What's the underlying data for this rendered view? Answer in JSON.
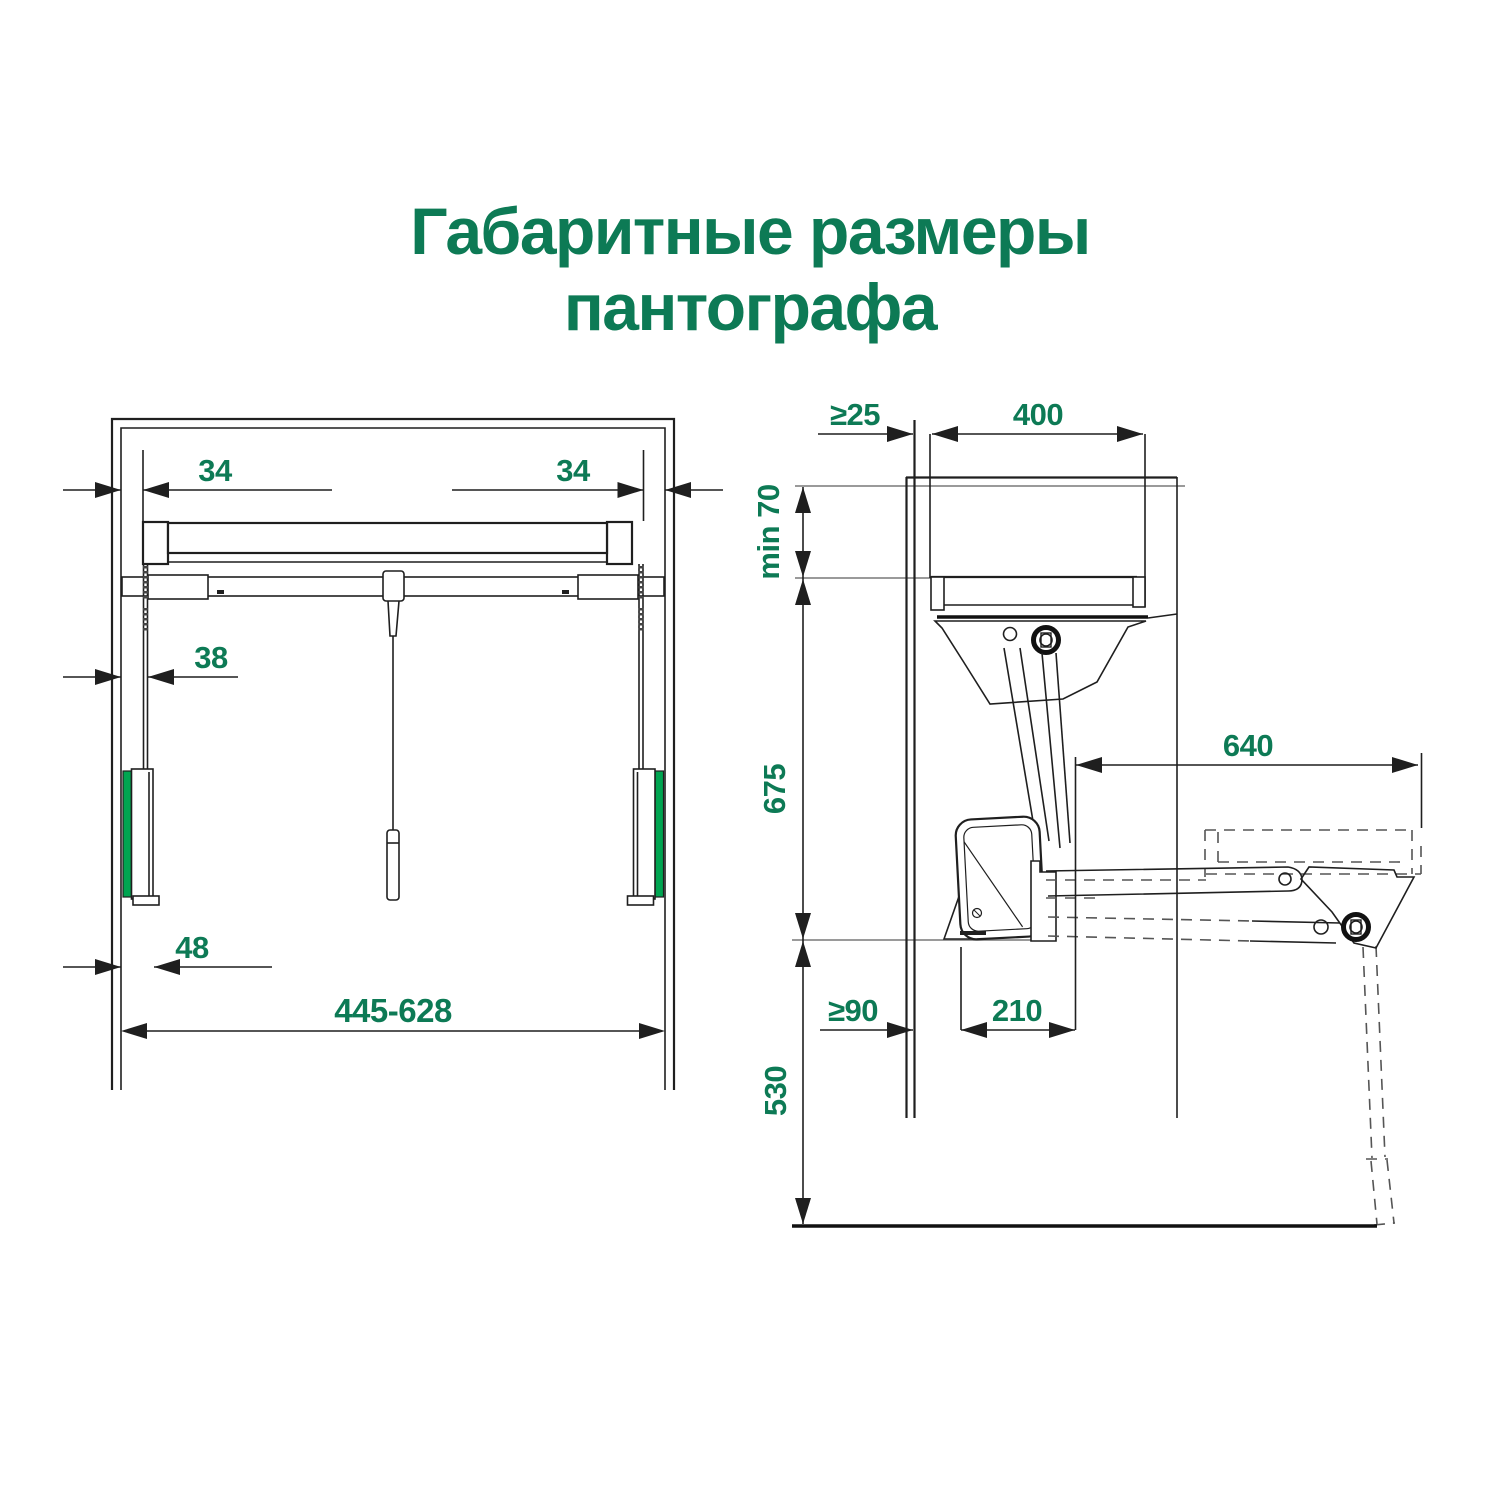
{
  "title": {
    "line1": "Габаритные размеры",
    "line2": "пантографа"
  },
  "colors": {
    "accent_green": "#0d7a55",
    "rail_pad_green": "#00a551",
    "line_black": "#1f1f1f",
    "extension_gray": "#8c8c8c"
  },
  "front_view": {
    "dims": {
      "rail_offset_left": "34",
      "rail_offset_right": "34",
      "bracket_offset": "38",
      "shoe_offset": "48",
      "width_range": "445-628"
    }
  },
  "side_view": {
    "dims": {
      "wall_clearance": "≥25",
      "cabinet_depth": "400",
      "top_clearance": "min 70",
      "upper_travel": "675",
      "extension_reach": "640",
      "front_clearance": "≥90",
      "unit_depth": "210",
      "lower_travel": "530"
    }
  }
}
